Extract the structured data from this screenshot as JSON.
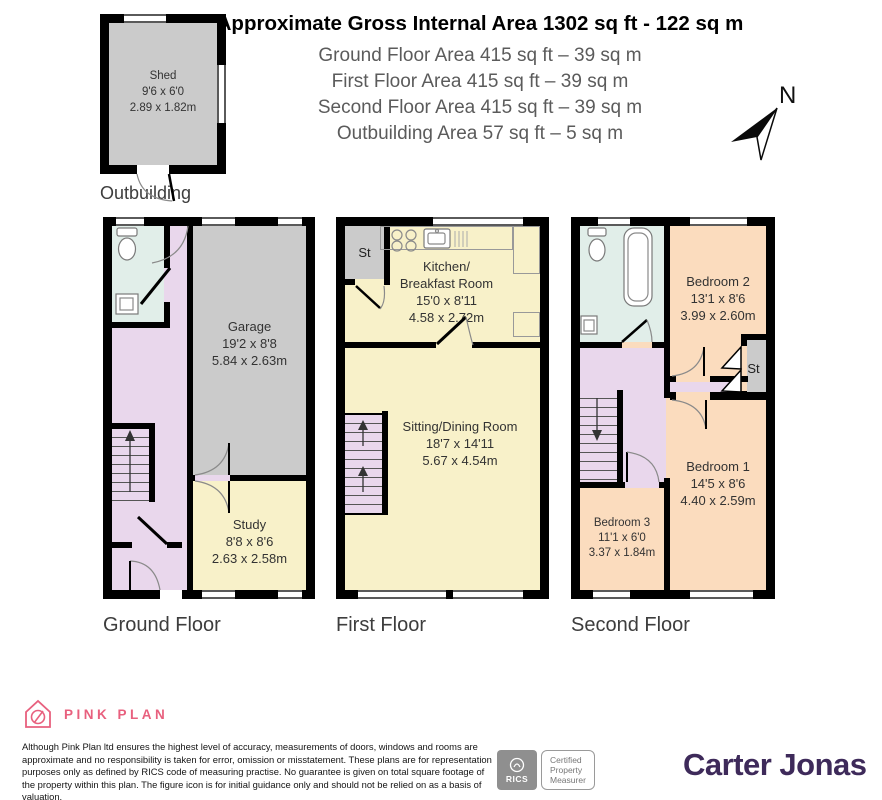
{
  "header": {
    "title": "Approximate Gross Internal Area 1302 sq ft - 122 sq m",
    "lines": [
      "Ground Floor Area 415 sq ft – 39 sq m",
      "First Floor Area 415 sq ft – 39 sq m",
      "Second Floor Area 415 sq ft – 39 sq m",
      "Outbuilding Area 57 sq ft – 5 sq m"
    ]
  },
  "compass": {
    "north": "N"
  },
  "outbuilding": {
    "label": "Outbuilding",
    "shed": {
      "name": "Shed",
      "imperial": "9'6 x 6'0",
      "metric": "2.89 x 1.82m"
    }
  },
  "ground": {
    "label": "Ground Floor",
    "garage": {
      "name": "Garage",
      "imperial": "19'2 x 8'8",
      "metric": "5.84 x 2.63m"
    },
    "study": {
      "name": "Study",
      "imperial": "8'8 x 8'6",
      "metric": "2.63 x 2.58m"
    }
  },
  "first": {
    "label": "First Floor",
    "st": "St",
    "kitchen": {
      "name1": "Kitchen/",
      "name2": "Breakfast Room",
      "imperial": "15'0 x 8'11",
      "metric": "4.58 x 2.72m"
    },
    "sitting": {
      "name": "Sitting/Dining Room",
      "imperial": "18'7 x 14'11",
      "metric": "5.67 x 4.54m"
    }
  },
  "second": {
    "label": "Second Floor",
    "st": "St",
    "bedroom2": {
      "name": "Bedroom 2",
      "imperial": "13'1 x 8'6",
      "metric": "3.99 x 2.60m"
    },
    "bedroom1": {
      "name": "Bedroom 1",
      "imperial": "14'5 x 8'6",
      "metric": "4.40 x 2.59m"
    },
    "bedroom3": {
      "name": "Bedroom 3",
      "imperial": "11'1 x 6'0",
      "metric": "3.37 x 1.84m"
    }
  },
  "footer": {
    "brand": "PINK PLAN",
    "disclaimer": "Although Pink Plan ltd ensures the highest level of accuracy, measurements of doors, windows and rooms are approximate and no responsibility is taken for error, omission or misstatement. These plans are for representation purposes only as defined by RICS code of measuring practise. No guarantee is given on total square footage of the property within this plan. The figure icon is for initial guidance only and should not be relied on as a basis of valuation.",
    "rics": {
      "abbr": "RICS",
      "line1": "Certified",
      "line2": "Property",
      "line3": "Measurer"
    },
    "agent": "Carter Jonas"
  },
  "colors": {
    "wall": "#000000",
    "hall_pink": "#E9D7EC",
    "bath_cyan": "#E1EEE9",
    "room_yellow": "#F8F1C9",
    "bedroom_peach": "#FBDCBE",
    "garage_gray": "#CBCBCB",
    "brand_pink": "#E8607E",
    "agent_purple": "#3E2A5A"
  }
}
